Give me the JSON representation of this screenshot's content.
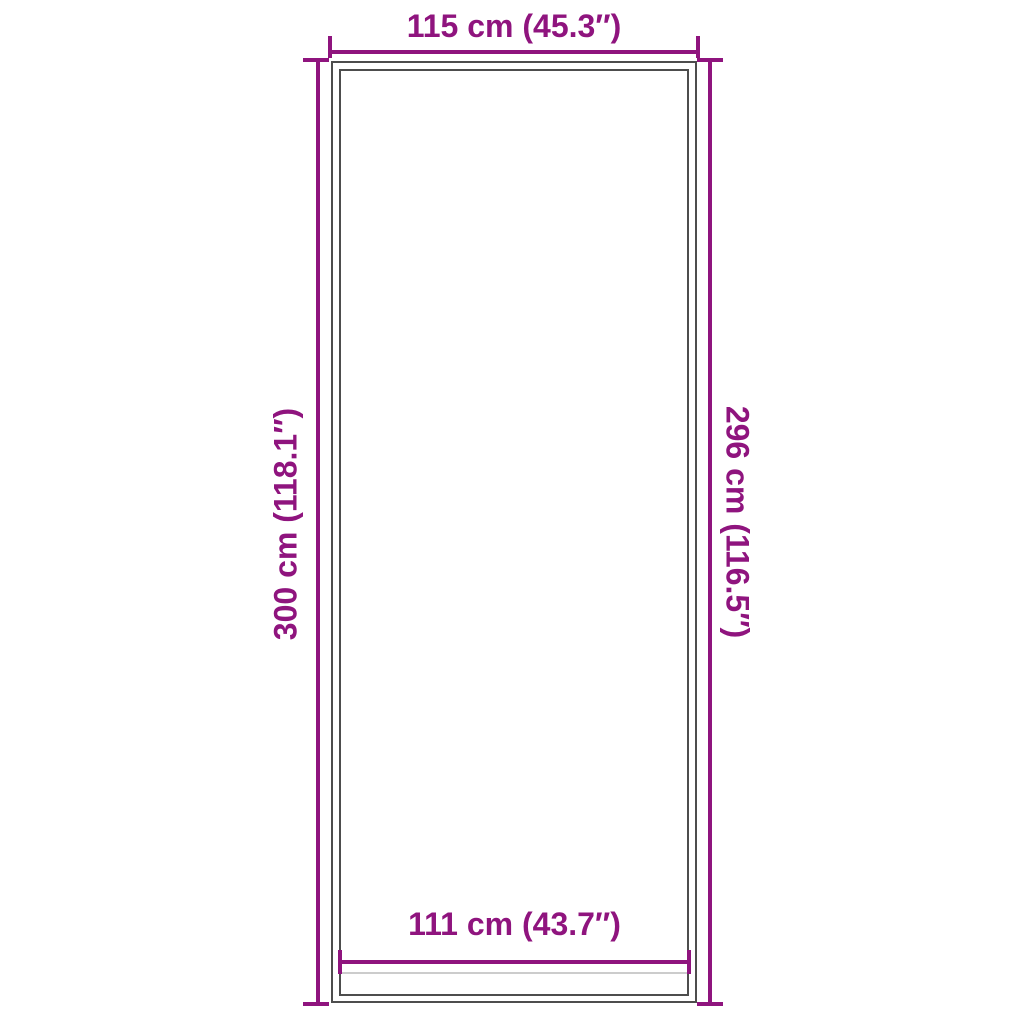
{
  "diagram": {
    "labels": {
      "outer_width": "115 cm (45.3″)",
      "outer_height": "300 cm (118.1″)",
      "inner_height": "296 cm (116.5″)",
      "inner_width": "111 cm (43.7″)"
    }
  },
  "colors": {
    "dimension_line": "#8f147e",
    "mat_outline": "#4d4d4d",
    "fold_line": "#cccccc",
    "background": "#ffffff"
  }
}
